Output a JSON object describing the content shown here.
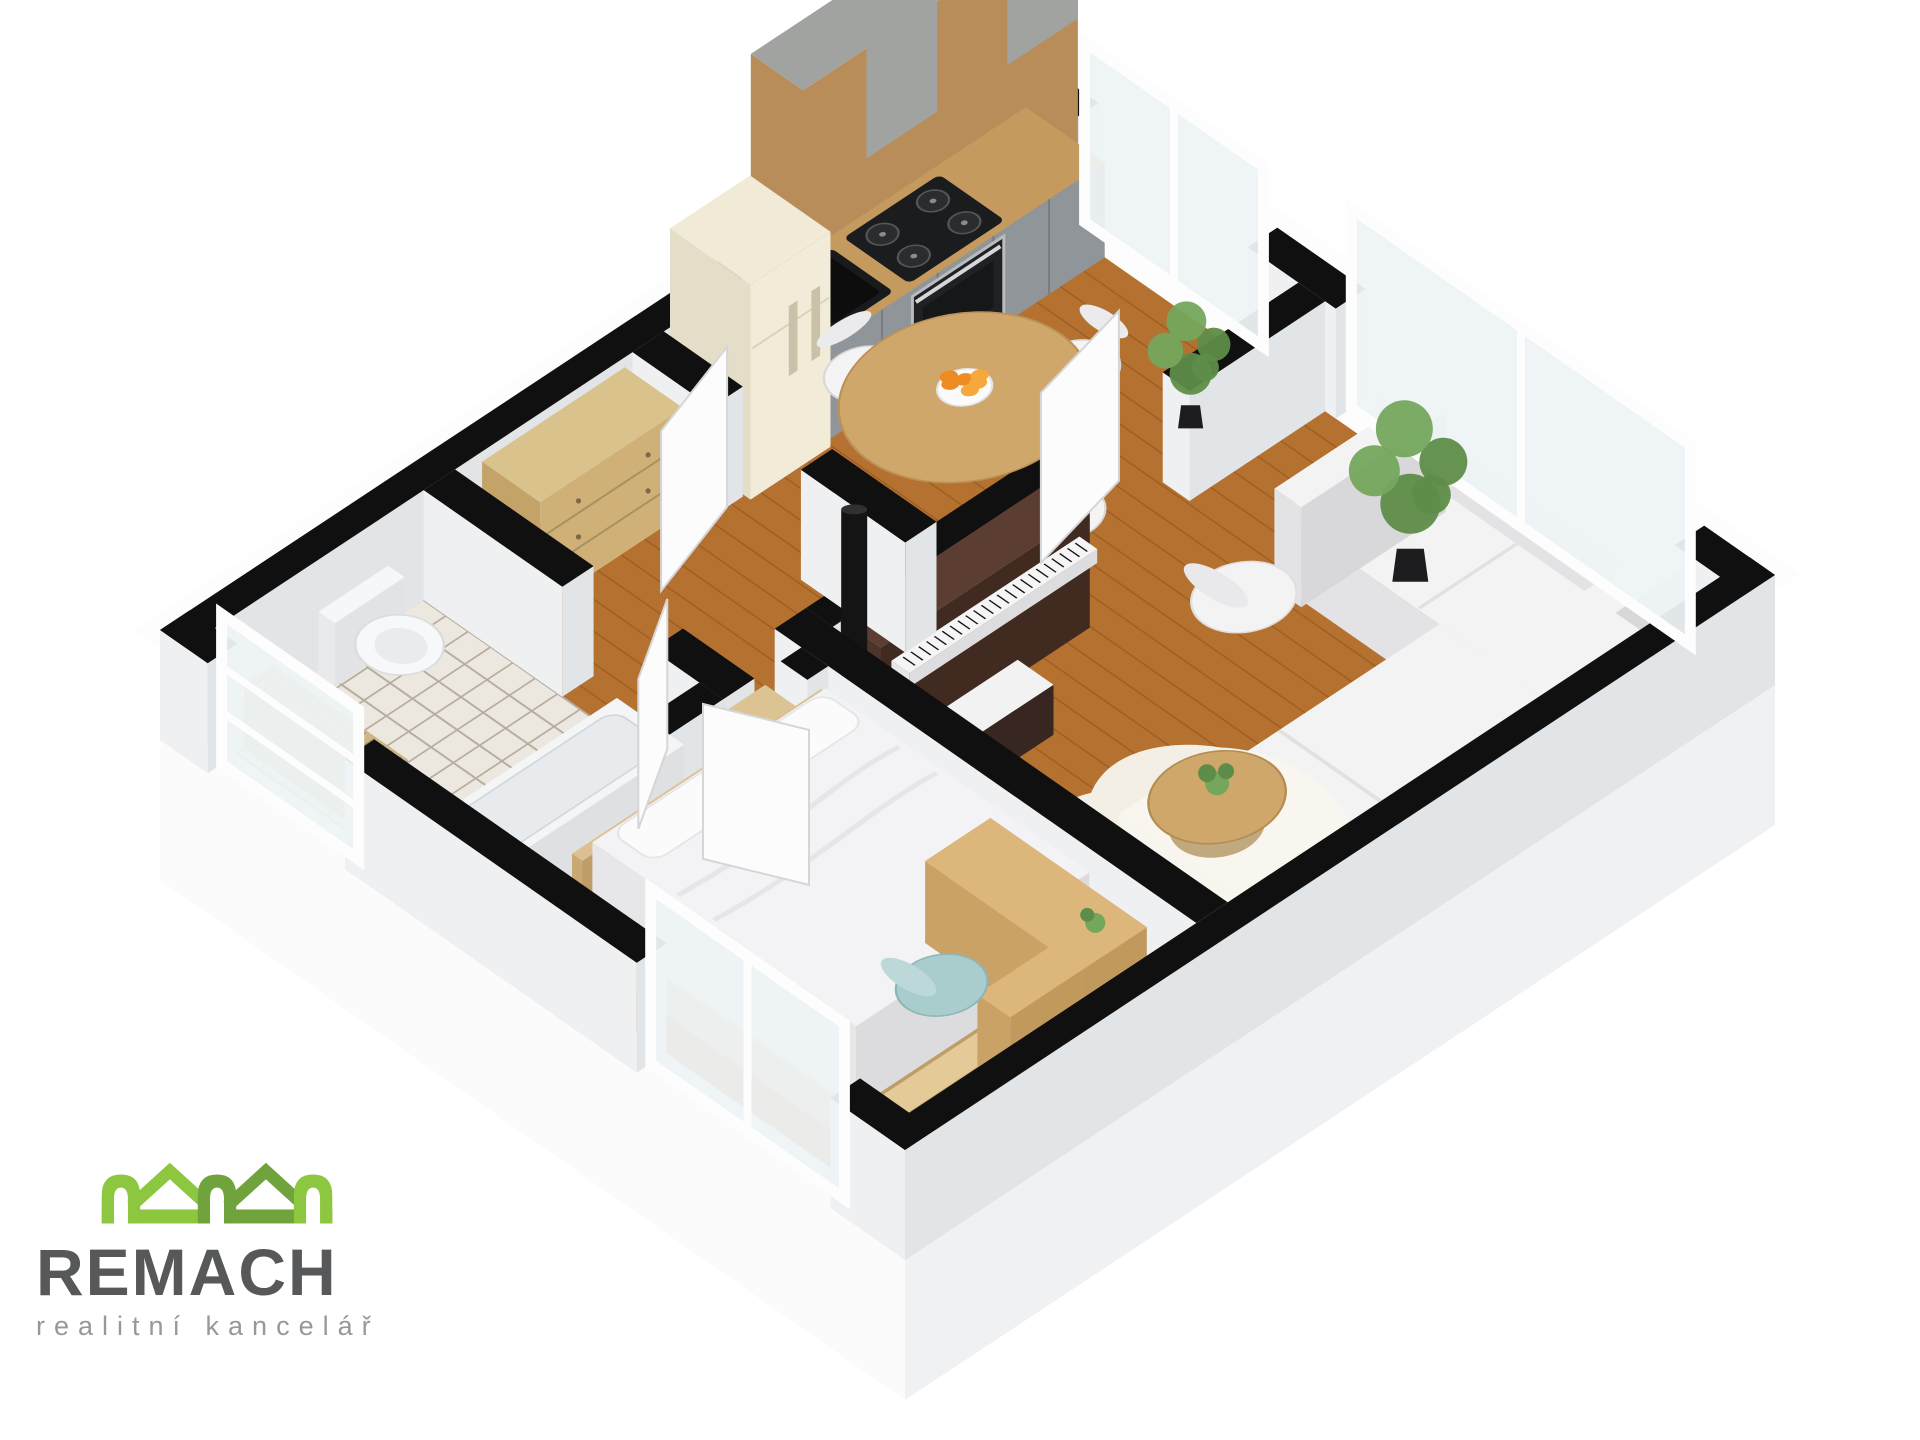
{
  "branding": {
    "name": "REMACH",
    "tagline": "realitní kancelář",
    "logo_green_light": "#8dc63f",
    "logo_green_dark": "#71a33c",
    "text_dark": "#56585a",
    "text_gray": "#96989b"
  },
  "floorplan": {
    "type": "3d-isometric-floorplan",
    "rooms": [
      {
        "id": "kitchen-dining",
        "label": "Kitchen / Dining room",
        "floor": "wood",
        "furniture": [
          "tall-cabinet-unit",
          "kitchen-counter",
          "gas-cooktop",
          "built-in-oven",
          "black-sink",
          "retro-fridge",
          "round-dining-table",
          "dining-chair",
          "dining-chair",
          "dining-chair",
          "dining-chair",
          "bowl-of-oranges",
          "stove-pipe-column",
          "potted-palm",
          "window"
        ]
      },
      {
        "id": "living-room",
        "label": "Living room",
        "floor": "wood",
        "furniture": [
          "corner-sofa",
          "armchair",
          "coffee-table",
          "coffee-table-plant",
          "cowhide-rug",
          "upright-piano",
          "piano-bench",
          "potted-ficus",
          "window"
        ]
      },
      {
        "id": "bedroom",
        "label": "Bedroom",
        "floor": "wood",
        "furniture": [
          "double-bed",
          "headboard",
          "pillows",
          "foot-bench",
          "desk",
          "desk-plant",
          "teal-chair",
          "window"
        ]
      },
      {
        "id": "bathroom",
        "label": "Bathroom",
        "floor": "tiles",
        "furniture": [
          "toilet",
          "bathtub",
          "radiator",
          "glass-window-screen",
          "door"
        ]
      },
      {
        "id": "hallway",
        "label": "Hallway",
        "floor": "wood",
        "furniture": [
          "chest-of-drawers",
          "side-table",
          "door",
          "door",
          "door"
        ]
      }
    ],
    "style": {
      "wall": "#101011",
      "wallFaceLight": "#eef0f2",
      "wallFaceDark": "#e2e5e8",
      "outerFace": "#fbfbfc",
      "outerFace2": "#f0f1f3",
      "wood": "#b5712f",
      "woodLine": "rgba(92,45,8,0.26)",
      "tile": "#ece7df",
      "grout": "#b5ad9f",
      "glass": "#eef3f5",
      "frame": "#fdfdfd",
      "sofa": "#f3f3f4",
      "sofaShade": "#e3e3e6",
      "sofaShade2": "#d8d8db",
      "counterGray": "#8f9598",
      "counterTop": "#c49a5f",
      "cabinetWood": "#b98d5a",
      "concrete": "#a0a3a0",
      "fridge": "#f0ead7",
      "piano": "#5b3d31",
      "tableWood": "#cfa76a",
      "orange": "#ee8b22",
      "plantGreen1": "#5e8d49",
      "plantGreen2": "#74a65c",
      "teal": "#a9cdcd",
      "bedWood": "#dcc091",
      "linen": "#f3f3f5"
    }
  }
}
